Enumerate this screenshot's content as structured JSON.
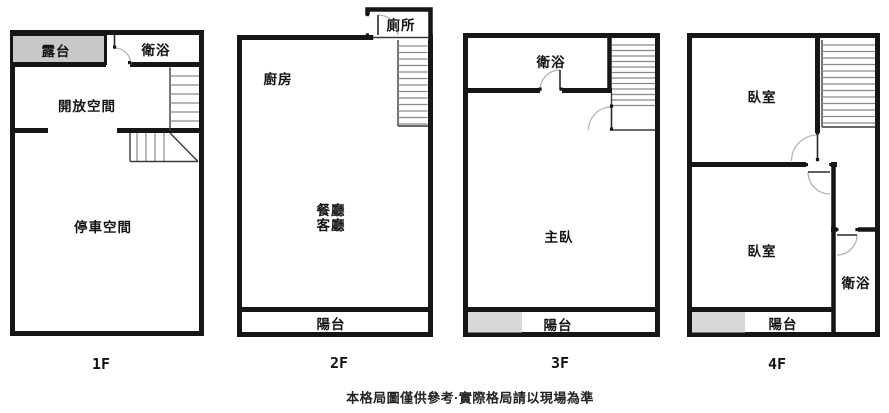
{
  "colors": {
    "wall": "#161616",
    "terrace_fill": "#c8c8c8",
    "balcony_fill": "#d8d8d8",
    "stair_line": "#8a8a8a",
    "door_arc": "#b5b5b5"
  },
  "floors": [
    {
      "label": "1F",
      "rooms": {
        "terrace": "露台",
        "bath": "衛浴",
        "open_space": "開放空間",
        "parking": "停車空間"
      }
    },
    {
      "label": "2F",
      "rooms": {
        "toilet": "廁所",
        "kitchen": "廚房",
        "dining": "餐廳",
        "living": "客廳",
        "balcony": "陽台"
      }
    },
    {
      "label": "3F",
      "rooms": {
        "bath": "衛浴",
        "master_bedroom": "主臥",
        "balcony": "陽台"
      }
    },
    {
      "label": "4F",
      "rooms": {
        "bedroom_upper": "臥室",
        "bedroom_lower": "臥室",
        "bath": "衛浴",
        "balcony": "陽台"
      }
    }
  ],
  "caption": "本格局圖僅供參考·實際格局請以現場為準"
}
